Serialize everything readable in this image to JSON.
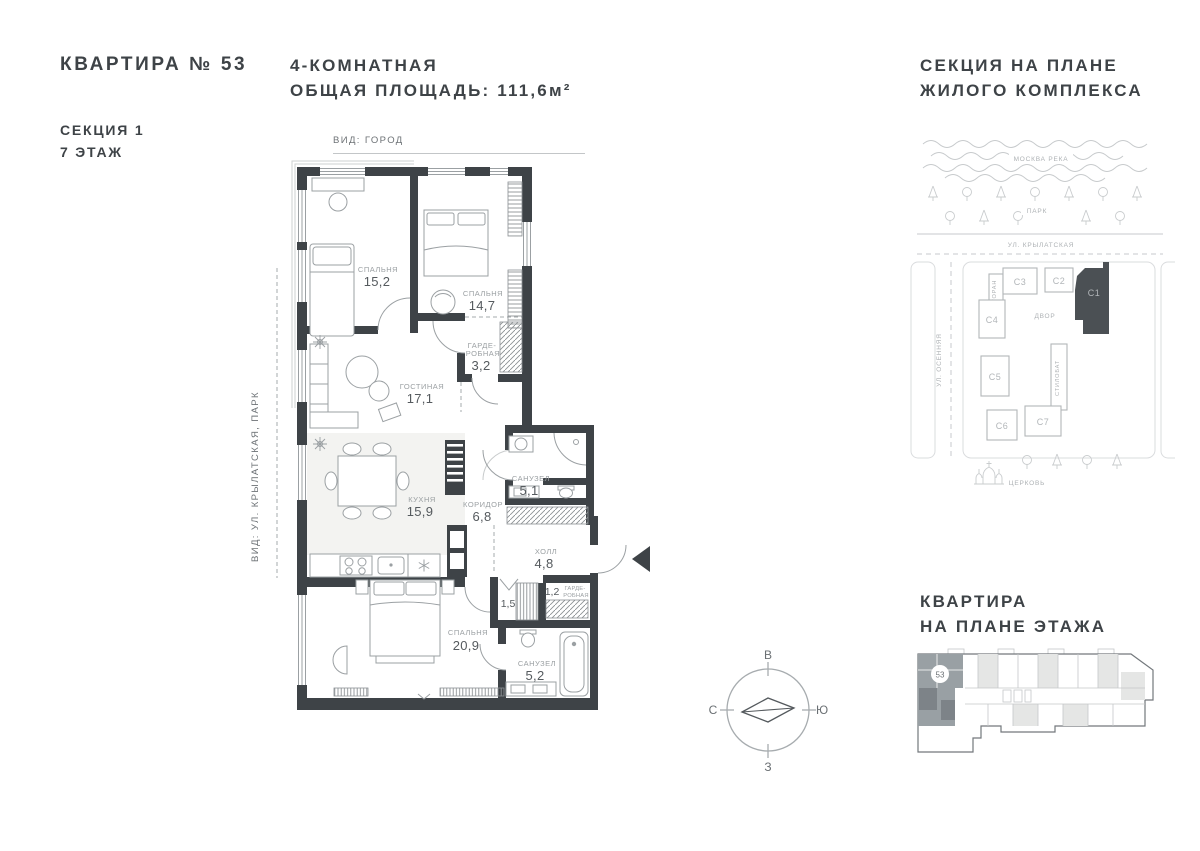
{
  "header": {
    "apartment_title": "КВАРТИРА № 53",
    "section": "СЕКЦИЯ 1",
    "floor": "7 ЭТАЖ",
    "type": "4-КОМНАТНАЯ",
    "total_area": "ОБЩАЯ ПЛОЩАДЬ: 111,6м²"
  },
  "plan": {
    "view_top": "ВИД: ГОРОД",
    "view_left": "ВИД: УЛ. КРЫЛАТСКАЯ, ПАРК",
    "rooms": {
      "bedroom1": {
        "name": "СПАЛЬНЯ",
        "area": "15,2"
      },
      "bedroom2": {
        "name": "СПАЛЬНЯ",
        "area": "14,7"
      },
      "wardrobe1": {
        "name_line1": "ГАРДЕ-",
        "name_line2": "РОБНАЯ",
        "area": "3,2"
      },
      "living": {
        "name": "ГОСТИНАЯ",
        "area": "17,1"
      },
      "kitchen": {
        "name": "КУХНЯ",
        "area": "15,9"
      },
      "corridor": {
        "name": "КОРИДОР",
        "area": "6,8"
      },
      "bath1": {
        "name": "САНУЗЕЛ",
        "area": "5,1"
      },
      "hall": {
        "name": "ХОЛЛ",
        "area": "4,8"
      },
      "closet": {
        "area": "1,5"
      },
      "wardrobe2": {
        "area": "1,2",
        "name_line1": "ГАРДЕ-",
        "name_line2": "РОБНАЯ"
      },
      "bedroom3": {
        "name": "СПАЛЬНЯ",
        "area": "20,9"
      },
      "bath2": {
        "name": "САНУЗЕЛ",
        "area": "5,2"
      }
    }
  },
  "site_plan": {
    "title_line1": "СЕКЦИЯ НА ПЛАНЕ",
    "title_line2": "ЖИЛОГО КОМПЛЕКСА",
    "river": "МОСКВА РЕКА",
    "park": "ПАРК",
    "street_top": "УЛ. КРЫЛАТСКАЯ",
    "street_left": "УЛ. ОСЕННЯЯ",
    "courtyard": "ДВОР",
    "restaurant": "РЕСТОРАН",
    "stylobate": "СТИЛОБАТ",
    "church": "ЦЕРКОВЬ",
    "buildings": {
      "c1": "С1",
      "c2": "С2",
      "c3": "С3",
      "c4": "С4",
      "c5": "С5",
      "c6": "С6",
      "c7": "С7"
    },
    "highlighted_building": "С1"
  },
  "floor_plate": {
    "title_line1": "КВАРТИРА",
    "title_line2": "НА ПЛАНЕ ЭТАЖА",
    "unit_number": "53"
  },
  "compass": {
    "top": "В",
    "left": "С",
    "right": "Ю",
    "bottom": "З"
  },
  "colors": {
    "wall": "#3E4347",
    "highlight_building": "#4B5054",
    "highlight_unit": "#99A0A4",
    "label_gray": "#9BA0A3"
  }
}
